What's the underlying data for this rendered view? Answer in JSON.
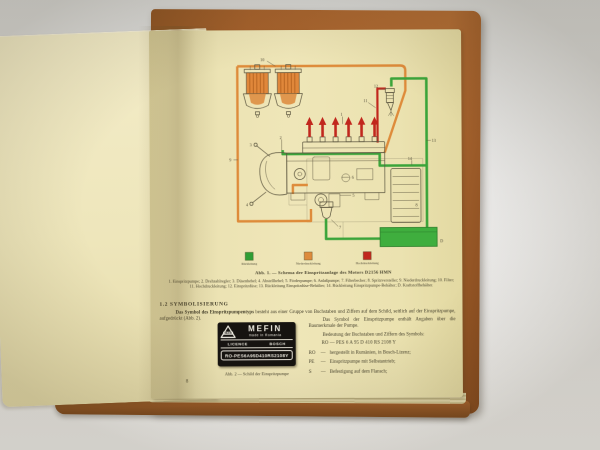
{
  "photo": {
    "background_color": "#e2e1df",
    "book_cover_color": "#a5612c",
    "page_color": "#ece3b4"
  },
  "page": {
    "page_number": "8",
    "figure1": {
      "caption": "Abb. 1. — Schema der Einspritzanlage des Motors D2156 HMN",
      "parts_list": "1. Einspritzpumpe; 2. Drehzahlregler; 3. Düsenhebel; 4. Abstellhebel; 5. Förderpumpe; 6. Anlaßpumpe; 7. Filterbecher; 8. Spritzversteller; 9. Niederdruckleitung; 10. Filter; 11. Hochdruckleitung; 12. Einspritzdüse; 13. Rückleitung Einspritzdüse-Behälter; 14. Rückleitung Einspritzpumpe-Behälter; D. Kraftstoffbehälter.",
      "legend": [
        {
          "label": "Rückleitung",
          "color": "#2f9e35"
        },
        {
          "label": "Niederdruckleitung",
          "color": "#dd8b3c"
        },
        {
          "label": "Hochdruckleitung",
          "color": "#c1271d"
        }
      ],
      "diagram_labels": [
        "10",
        "2",
        "3",
        "4",
        "9",
        "1",
        "11",
        "12",
        "13",
        "14",
        "8",
        "6",
        "5",
        "7",
        "D"
      ]
    },
    "section": {
      "heading": "1.2 SYMBOLISIERUNG",
      "para1_lead": "Das Symbol des Einspritzpumpentyps",
      "para1_rest": " besteht aus einer Gruppe von Buchstaben und Ziffern auf dem Schild, seitlich auf der Einspritzpumpe, aufgedrückt (Abb. 2).",
      "para2": "Das Symbol der Einspritzpumpe enthält Angaben über die Baumerkmale der Pumpe.",
      "para3": "Bedeutung der Buchstaben und Ziffern des Symbols:",
      "symbol_code": "RO — PES 6 A 95 D 410 RS 2108 Y",
      "dash": "—",
      "definitions": [
        {
          "key": "RO",
          "text": "hergestellt in Rumänien, in Bosch-Lizenz;"
        },
        {
          "key": "PE",
          "text": "Einspritzpumpe mit Selbstantrieb;"
        },
        {
          "key": "S",
          "text": "Befestigung auf dem Flansch;"
        }
      ]
    },
    "figure2": {
      "caption": "Abb. 2 — Schild der Einspritzpumpe",
      "plate": {
        "logo_text": "MEFIN",
        "brand": "MEFIN",
        "origin": "made in Romania",
        "licence_label": "LICENCE",
        "licensor": "BOSCH",
        "type_code": "RO-PES6A95D410RS2108Y"
      }
    }
  }
}
